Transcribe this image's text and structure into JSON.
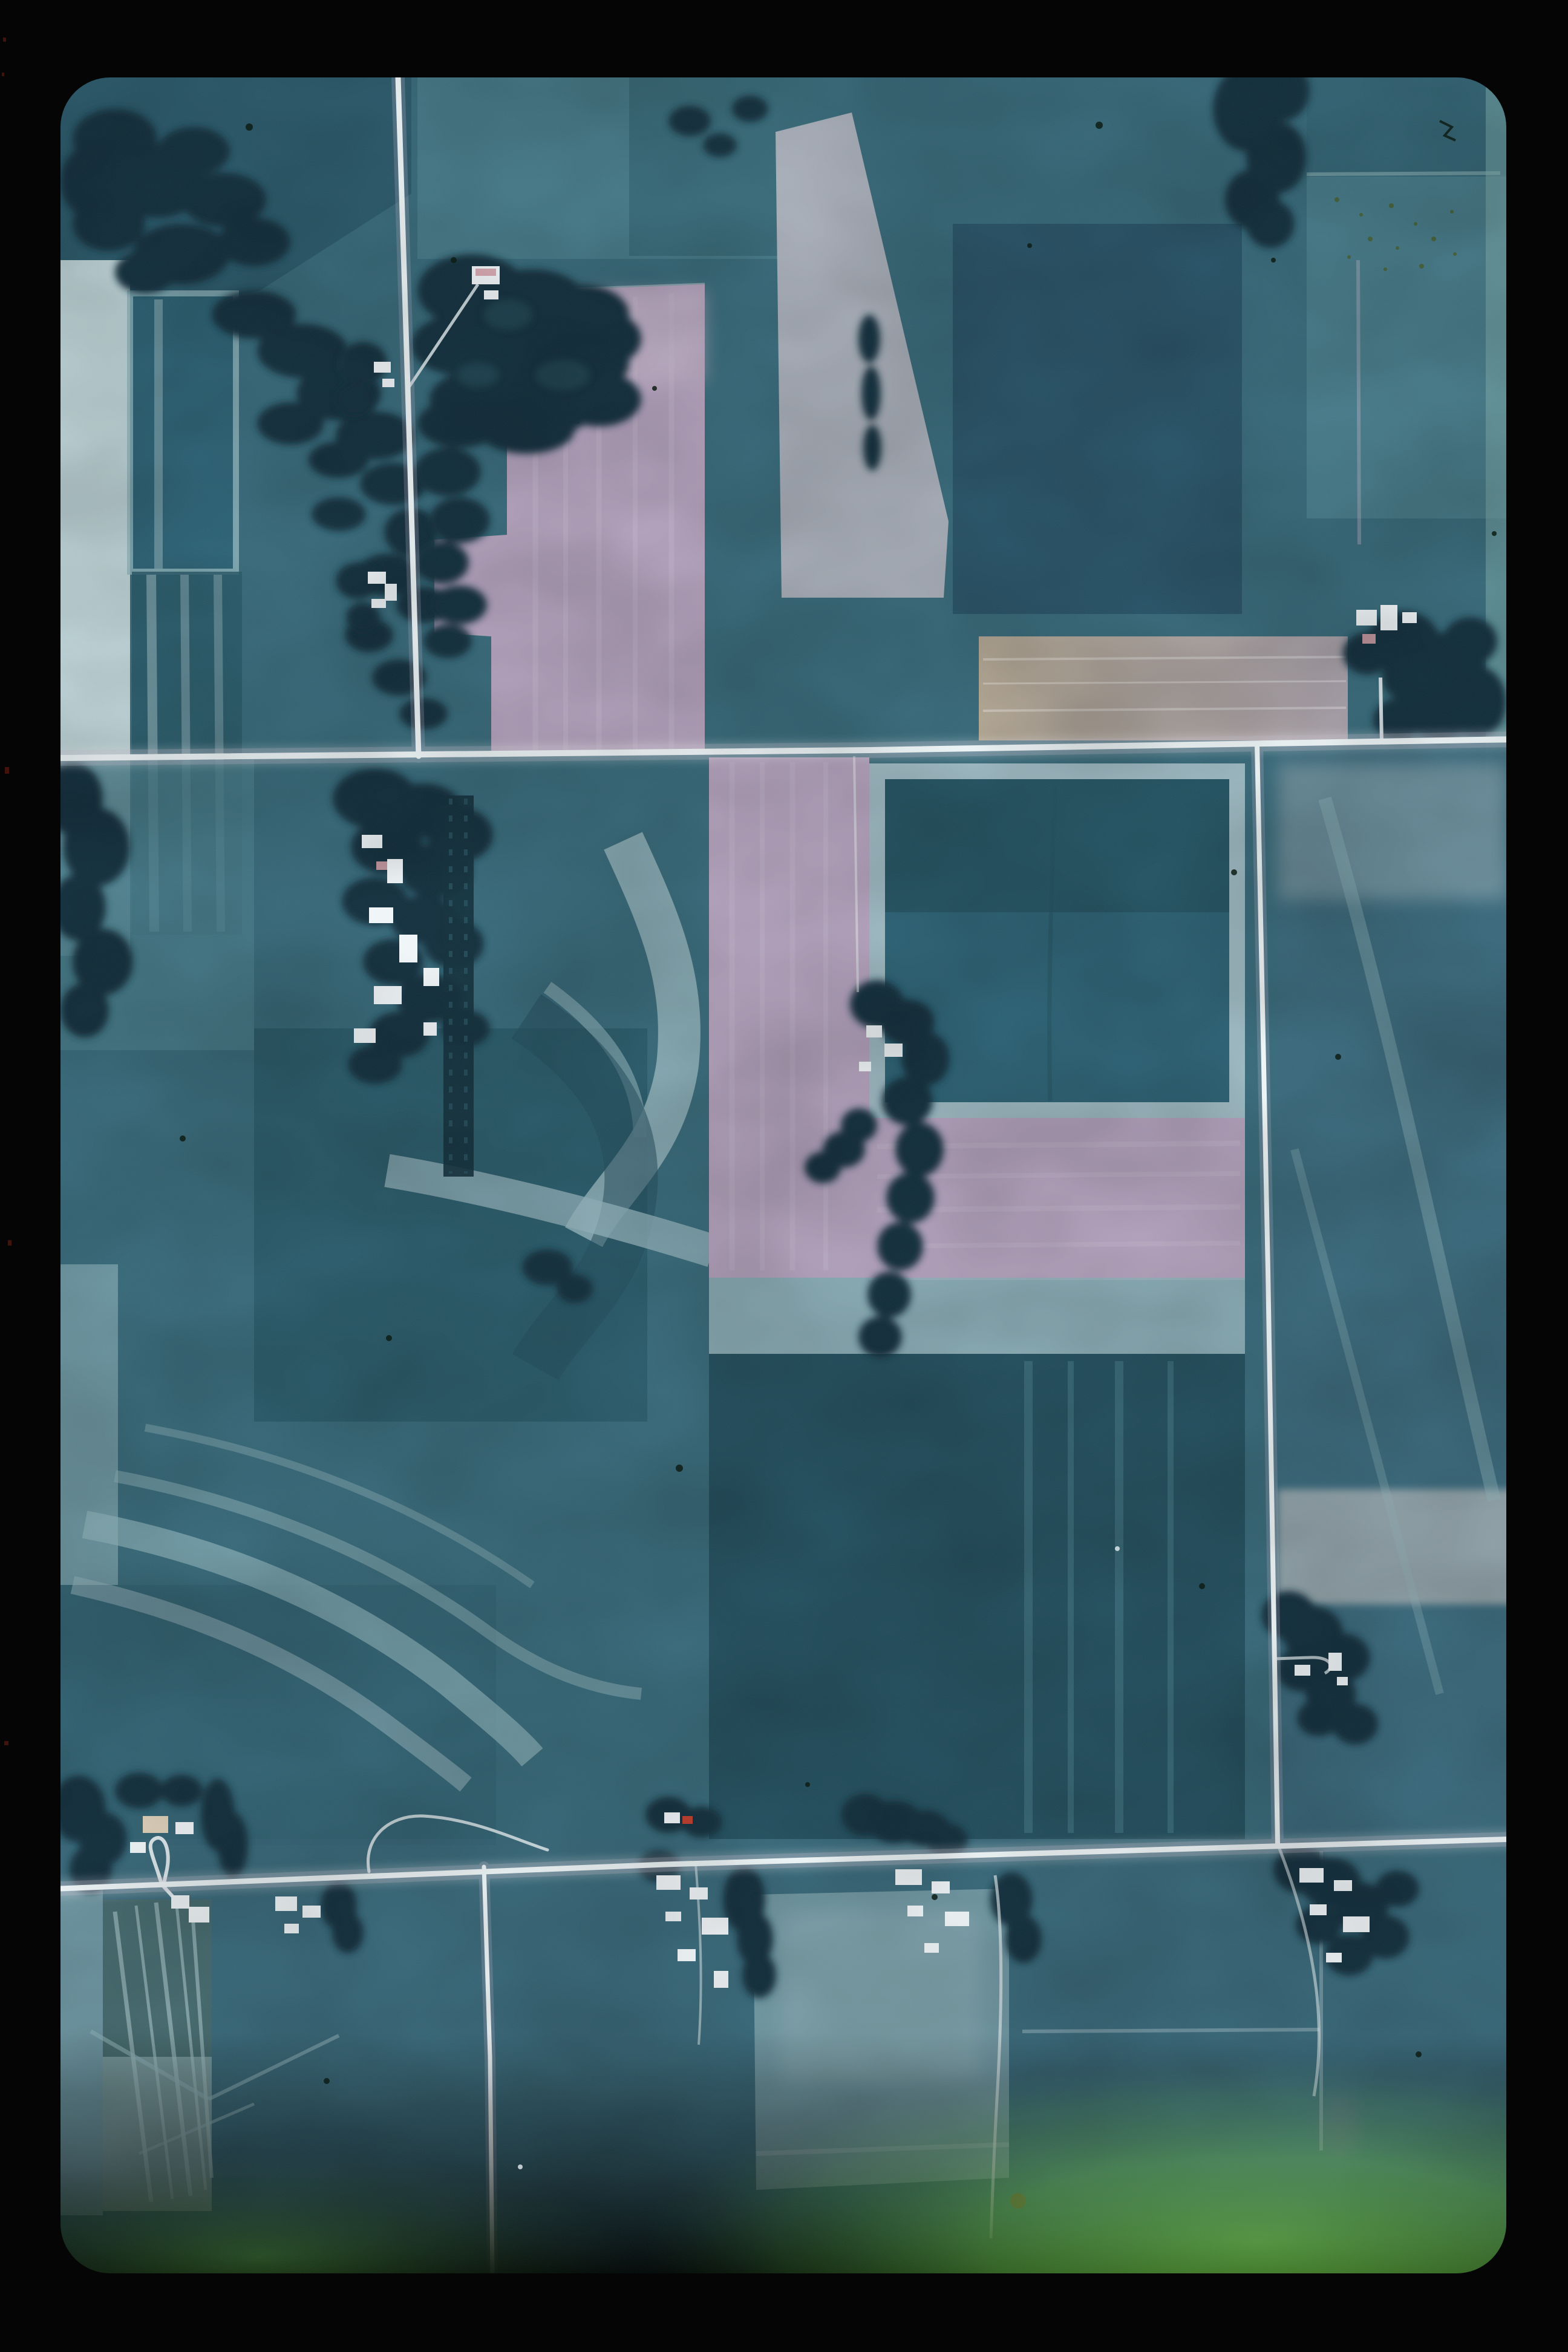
{
  "scene": {
    "kind": "film-slide aerial photograph",
    "description": "Vertical color-infrared aerial photo of a rural farmland grid seen through a dark slide mount; two horizontal section roads, three vertical roads, scattered farmsteads with white buildings, woodlots, teal crop fields, pink plowed fields and a green light-leak along the bottom edge.",
    "counts": {
      "horizontal_roads": 2,
      "vertical_roads": 3,
      "farmsteads": 10,
      "woodlots": 8
    }
  },
  "palette": {
    "frame": "#050506",
    "photo_base": "#3a6b7b",
    "teal_dark": "#2c5a6a",
    "teal_deep": "#265160",
    "teal_mid": "#356574",
    "teal_light": "#4a7d8b",
    "teal_steel": "#3c6a7c",
    "mint_pale": "#8fb3ba",
    "pale_band": "#93b2ba",
    "strip_bright": "#bdd2d6",
    "blue_field": "#2b5569",
    "square_teal": "#2e6375",
    "border_pale": "#9db8c1",
    "woods": "#16333f",
    "woods_light": "#2a5361",
    "pink": "#b3a2bc",
    "pink_light": "#c6b6cb",
    "mauve": "#a9a2ab",
    "khaki": "#b3a794",
    "road": "#eef5f7",
    "verge": "#c3b8cb",
    "building": "#f0f5f8",
    "cream": "#ded0ba",
    "red_roof": "#bf4030",
    "pale_field": "#7097a2",
    "leak_green": "#4f8f2e",
    "leak_mid": "#3c7323",
    "leak_deep": "#244a16",
    "leak_left": "#2e5a1d",
    "speck": "#0e1d15",
    "speck_red": "#4a140c",
    "blemish_red": "#8a4030",
    "smudge_purple": "#8a6a9a"
  }
}
